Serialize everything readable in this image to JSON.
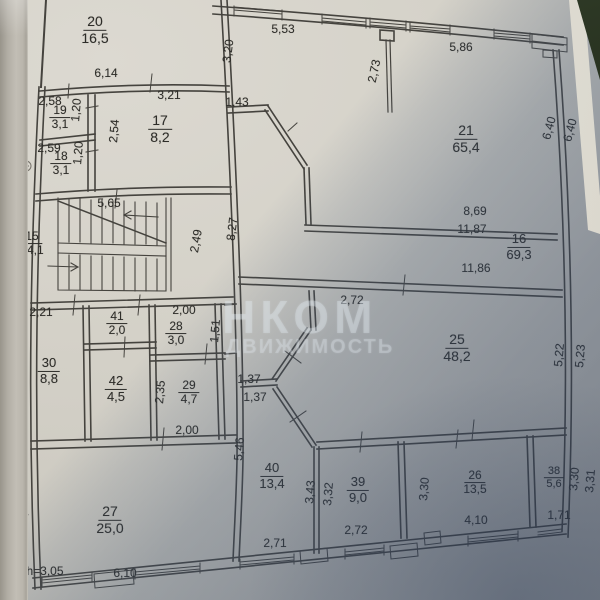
{
  "document": {
    "kind": "floor-plan-photo"
  },
  "colors": {
    "ink": "#2e2d29",
    "paper": "#d5d2c9",
    "shadow_tint": "#425670",
    "watermark": "#e2e9f1",
    "background_corner": "#1c2613"
  },
  "watermark": {
    "line1": "НКОМ",
    "line2": "ДВИЖИМОСТЬ"
  },
  "rooms": [
    {
      "number": "20",
      "area": "16,5",
      "x": 95,
      "y": 30,
      "s": 14
    },
    {
      "number": "19",
      "area": "3,1",
      "x": 60,
      "y": 118,
      "s": 12
    },
    {
      "number": "18",
      "area": "3,1",
      "x": 61,
      "y": 164,
      "s": 12
    },
    {
      "number": "17",
      "area": "8,2",
      "x": 160,
      "y": 129,
      "s": 14
    },
    {
      "number": "15",
      "area": "14,1",
      "x": 32,
      "y": 244,
      "s": 12
    },
    {
      "number": "21",
      "area": "65,4",
      "x": 466,
      "y": 139,
      "s": 14
    },
    {
      "number": "16",
      "area": "69,3",
      "x": 519,
      "y": 247,
      "s": 13
    },
    {
      "number": "25",
      "area": "48,2",
      "x": 457,
      "y": 348,
      "s": 14
    },
    {
      "number": "41",
      "area": "2,0",
      "x": 117,
      "y": 324,
      "s": 12
    },
    {
      "number": "28",
      "area": "3,0",
      "x": 176,
      "y": 334,
      "s": 12
    },
    {
      "number": "30",
      "area": "8,8",
      "x": 49,
      "y": 371,
      "s": 13
    },
    {
      "number": "42",
      "area": "4,5",
      "x": 116,
      "y": 389,
      "s": 13
    },
    {
      "number": "29",
      "area": "4,7",
      "x": 189,
      "y": 393,
      "s": 12
    },
    {
      "number": "40",
      "area": "13,4",
      "x": 272,
      "y": 476,
      "s": 13
    },
    {
      "number": "39",
      "area": "9,0",
      "x": 358,
      "y": 490,
      "s": 13
    },
    {
      "number": "26",
      "area": "13,5",
      "x": 475,
      "y": 483,
      "s": 12
    },
    {
      "number": "38",
      "area": "5,6",
      "x": 554,
      "y": 478,
      "s": 11
    },
    {
      "number": "27",
      "area": "25,0",
      "x": 110,
      "y": 520,
      "s": 14
    }
  ],
  "dims": [
    {
      "t": "6,14",
      "x": 106,
      "y": 73
    },
    {
      "t": "3,21",
      "x": 169,
      "y": 95
    },
    {
      "t": "2,58",
      "x": 50,
      "y": 101
    },
    {
      "t": "1,20",
      "x": 76,
      "y": 110,
      "r": -85
    },
    {
      "t": "2,59",
      "x": 49,
      "y": 148
    },
    {
      "t": "1,20",
      "x": 78,
      "y": 153,
      "r": -85
    },
    {
      "t": "2,54",
      "x": 114,
      "y": 131,
      "r": -85
    },
    {
      "t": "5,65",
      "x": 109,
      "y": 203
    },
    {
      "t": "2,49",
      "x": 196,
      "y": 241,
      "r": -80
    },
    {
      "t": "8,27",
      "x": 232,
      "y": 229,
      "r": -83
    },
    {
      "t": "3,20",
      "x": 228,
      "y": 51,
      "r": -83
    },
    {
      "t": "1,43",
      "x": 237,
      "y": 102
    },
    {
      "t": "5,53",
      "x": 283,
      "y": 29
    },
    {
      "t": "2,73",
      "x": 374,
      "y": 71,
      "r": -78
    },
    {
      "t": "5,86",
      "x": 461,
      "y": 47
    },
    {
      "t": "6,40",
      "x": 549,
      "y": 128,
      "r": -75
    },
    {
      "t": "6,40",
      "x": 570,
      "y": 130,
      "r": -75
    },
    {
      "t": "8,69",
      "x": 475,
      "y": 211
    },
    {
      "t": "11,87",
      "x": 472,
      "y": 229
    },
    {
      "t": "11,86",
      "x": 476,
      "y": 268
    },
    {
      "t": "2,72",
      "x": 352,
      "y": 300
    },
    {
      "t": "5,22",
      "x": 559,
      "y": 355,
      "r": -85
    },
    {
      "t": "5,23",
      "x": 580,
      "y": 356,
      "r": -85
    },
    {
      "t": "2,21",
      "x": 41,
      "y": 312
    },
    {
      "t": "2,00",
      "x": 184,
      "y": 310
    },
    {
      "t": "1,51",
      "x": 215,
      "y": 331,
      "r": -85
    },
    {
      "t": "3,97",
      "x": 21,
      "y": 366,
      "r": -87
    },
    {
      "t": "2,35",
      "x": 160,
      "y": 392,
      "r": -85
    },
    {
      "t": "1,37",
      "x": 249,
      "y": 379
    },
    {
      "t": "1,37",
      "x": 255,
      "y": 397
    },
    {
      "t": "2,00",
      "x": 187,
      "y": 430
    },
    {
      "t": "5,46",
      "x": 239,
      "y": 449,
      "r": -85
    },
    {
      "t": "3,43",
      "x": 310,
      "y": 492,
      "r": -85
    },
    {
      "t": "3,32",
      "x": 328,
      "y": 494,
      "r": -85
    },
    {
      "t": "3,30",
      "x": 424,
      "y": 489,
      "r": -85
    },
    {
      "t": "3,30",
      "x": 574,
      "y": 479,
      "r": -85
    },
    {
      "t": "3,31",
      "x": 590,
      "y": 481,
      "r": -85
    },
    {
      "t": "4,13",
      "x": 23,
      "y": 511,
      "r": -87
    },
    {
      "t": "2,71",
      "x": 275,
      "y": 543
    },
    {
      "t": "2,72",
      "x": 356,
      "y": 530
    },
    {
      "t": "4,10",
      "x": 476,
      "y": 520
    },
    {
      "t": "1,71",
      "x": 559,
      "y": 515
    },
    {
      "t": "h=3,05",
      "x": 45,
      "y": 571
    },
    {
      "t": "6,10",
      "x": 125,
      "y": 573
    }
  ]
}
